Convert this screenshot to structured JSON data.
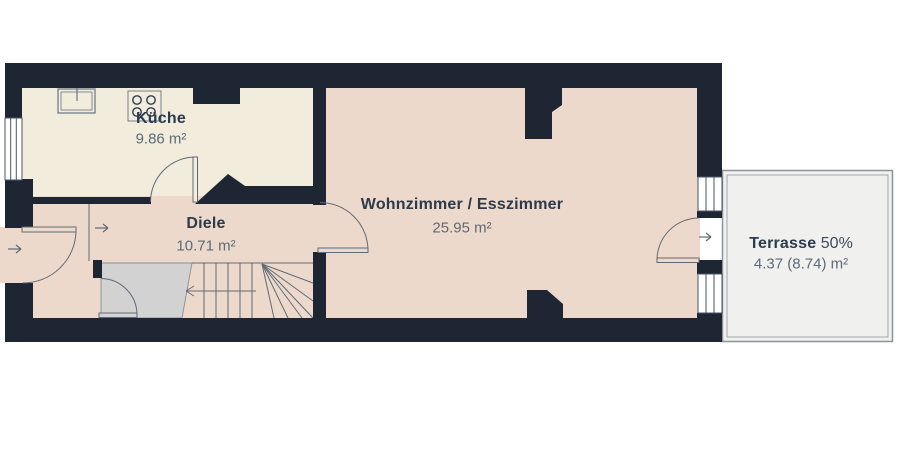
{
  "rooms": [
    {
      "id": "kueche",
      "name": "Küche",
      "area": "9.86 m²"
    },
    {
      "id": "diele",
      "name": "Diele",
      "area": "10.71 m²"
    },
    {
      "id": "wohnzimmer",
      "name": "Wohnzimmer / Esszimmer",
      "area": "25.95 m²"
    }
  ],
  "terrace": {
    "name": "Terrasse",
    "share": "50%",
    "area": "4.37 (8.74) m²"
  },
  "icons": [
    "sink-icon",
    "stove-icon",
    "entrance-arrow-icon",
    "vestibule-arrow-icon",
    "terrace-arrow-icon",
    "stairs-direction-arrow-icon",
    "door-swing-icon"
  ],
  "colors": {
    "wall": "#1e2634",
    "floor_kitchen": "#f1ecdb",
    "floor_main": "#edd9cb",
    "stairs_fill": "#d2d2d2",
    "terrace_fill": "#f0f0ee",
    "terrace_border": "#8d939b",
    "line": "#5f6a76",
    "window_frame": "#4a5563",
    "fixture_line": "#6b7482",
    "window_fill": "#ffffff",
    "label": "#2c3a4d",
    "label_muted": "#5d6a78",
    "background": "#ffffff"
  }
}
